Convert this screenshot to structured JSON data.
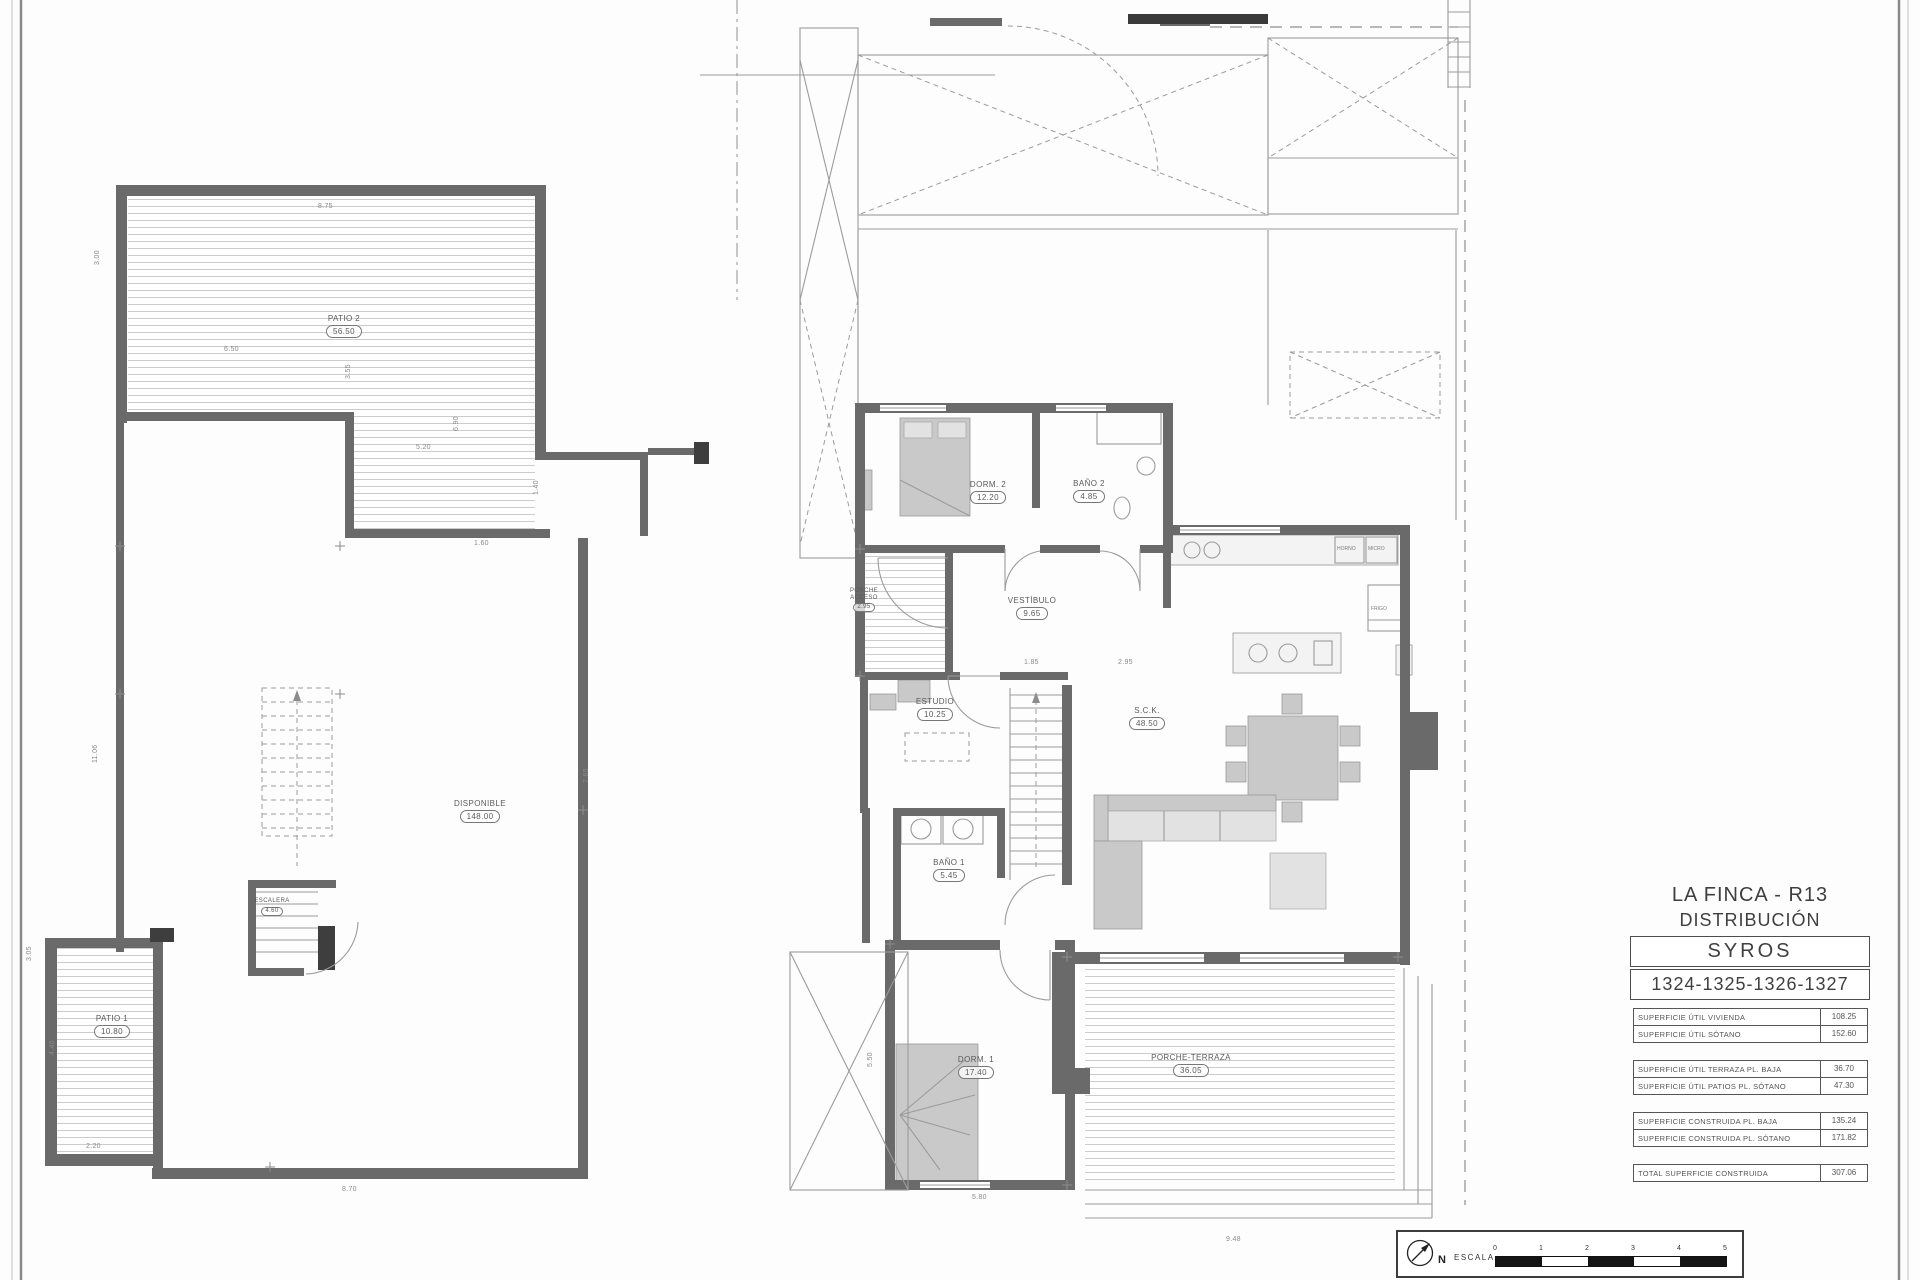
{
  "sheet": {
    "background": "#fdfdfd",
    "wall_color": "#6a6a6a",
    "line_color": "#9b9b9b",
    "hatch_color": "#cccccc"
  },
  "title_block": {
    "project": "LA FINCA - R13",
    "sheet_name": "DISTRIBUCIÓN",
    "model": "SYROS",
    "unit_numbers": "1324-1325-1326-1327",
    "area_tables": [
      {
        "rows": [
          {
            "label": "SUPERFICIE ÚTIL VIVIENDA",
            "value": "108.25"
          },
          {
            "label": "SUPERFICIE ÚTIL SÓTANO",
            "value": "152.60"
          }
        ]
      },
      {
        "rows": [
          {
            "label": "SUPERFICIE ÚTIL TERRAZA PL. BAJA",
            "value": "36.70"
          },
          {
            "label": "SUPERFICIE ÚTIL PATIOS PL. SÓTANO",
            "value": "47.30"
          }
        ]
      },
      {
        "rows": [
          {
            "label": "SUPERFICIE CONSTRUIDA PL. BAJA",
            "value": "135.24"
          },
          {
            "label": "SUPERFICIE CONSTRUIDA PL. SÓTANO",
            "value": "171.82"
          }
        ]
      },
      {
        "rows": [
          {
            "label": "TOTAL SUPERFICIE CONSTRUIDA",
            "value": "307.06"
          }
        ]
      }
    ]
  },
  "basement_plan": {
    "rooms": [
      {
        "name": "PATIO 2",
        "area": "56.50"
      },
      {
        "name": "DISPONIBLE",
        "area": "148.00"
      },
      {
        "name": "ESCALERA",
        "area": "4.60"
      },
      {
        "name": "PATIO 1",
        "area": "10.80"
      }
    ]
  },
  "ground_plan": {
    "rooms": [
      {
        "name": "DORM. 2",
        "area": "12.20"
      },
      {
        "name": "BAÑO 2",
        "area": "4.85"
      },
      {
        "name": "VESTÍBULO",
        "area": "9.65"
      },
      {
        "name": "PORCHE ACCESO",
        "area": "2.95"
      },
      {
        "name": "ESTUDIO",
        "area": "10.25"
      },
      {
        "name": "S.C.K.",
        "area": "48.50"
      },
      {
        "name": "BAÑO 1",
        "area": "5.45"
      },
      {
        "name": "DORM. 1",
        "area": "17.40"
      },
      {
        "name": "PORCHE-TERRAZA",
        "area": "36.05"
      }
    ]
  },
  "dimensions": {
    "basement": [
      "8.75",
      "3.00",
      "6.50",
      "3.55",
      "6.90",
      "5.20",
      "1.40",
      "1.60",
      "11.06",
      "7.65",
      "3.05",
      "4.40",
      "2.20",
      "8.70"
    ],
    "ground": [
      "1.85",
      "2.95",
      "5.50",
      "5.80",
      "9.48"
    ]
  },
  "kitchen": {
    "appliance_labels": [
      "FRIGO",
      "HORNO",
      "MICRO"
    ]
  },
  "scale_bar": {
    "north_label": "N",
    "scale_label": "ESCALA",
    "ticks": [
      "0",
      "1",
      "2",
      "3",
      "4",
      "5"
    ]
  }
}
